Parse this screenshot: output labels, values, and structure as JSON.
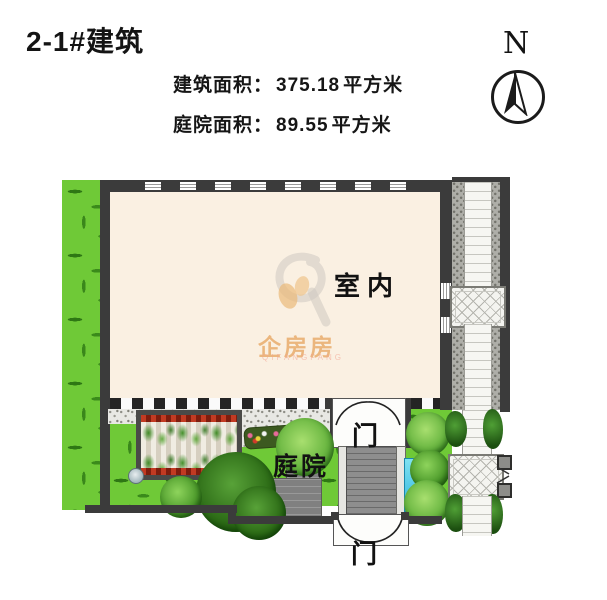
{
  "header": {
    "title": "2-1#建筑",
    "areas": [
      {
        "label": "建筑面积：",
        "value": "375.18",
        "unit": "平方米"
      },
      {
        "label": "庭院面积：",
        "value": "89.55",
        "unit": "平方米"
      }
    ]
  },
  "compass": {
    "label": "N"
  },
  "plan": {
    "room_label": "室内",
    "courtyard_label": "庭院",
    "gate_top_label": "门",
    "gate_bottom_label": "门"
  },
  "watermark": {
    "name": "企房房",
    "subtext": "QIFANGFANG"
  },
  "colors": {
    "grass": "#6fc937",
    "wall": "#3b3b3b",
    "interior": "#faf0e2",
    "water": "#3fc8e8",
    "watermark_orange": "#e2923e",
    "text": "#141414"
  }
}
